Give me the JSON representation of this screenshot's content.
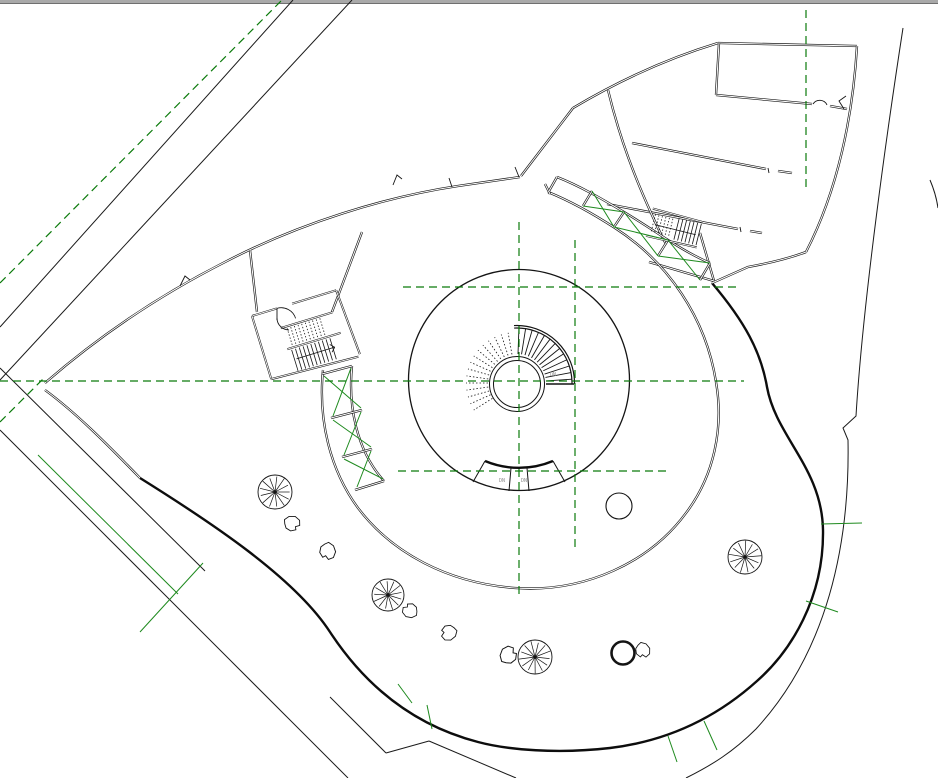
{
  "canvas": {
    "width": 938,
    "height": 778,
    "background": "#ffffff"
  },
  "colors": {
    "wall": "#141414",
    "site": "#1a1a1a",
    "bold": "#0d0d0d",
    "ref_green": "#0a7a0a",
    "accent_green": "#1e8a1e",
    "topbar_fill": "#a9a9a9",
    "topbar_edge": "#6f6f6f",
    "label_gray": "#8f8f8f",
    "white": "#ffffff"
  },
  "labels": {
    "down_labels": [
      {
        "text": "DN",
        "x": 550,
        "y": 376
      },
      {
        "text": "DN",
        "x": 499,
        "y": 482
      },
      {
        "text": "DN",
        "x": 521,
        "y": 482
      }
    ]
  },
  "window_edge": {
    "bar": {
      "x": 0,
      "y": 0,
      "w": 938,
      "h": 3
    },
    "edge_y": 3.5
  },
  "reference_grid": {
    "dash": "8 5",
    "lines": [
      {
        "x1": 403,
        "y1": 287,
        "x2": 737,
        "y2": 287
      },
      {
        "x1": 0,
        "y1": 381,
        "x2": 744,
        "y2": 381
      },
      {
        "x1": 398,
        "y1": 471,
        "x2": 666,
        "y2": 471
      },
      {
        "x1": 519,
        "y1": 222,
        "x2": 519,
        "y2": 597
      },
      {
        "x1": 575,
        "y1": 240,
        "x2": 575,
        "y2": 547
      },
      {
        "x1": 806,
        "y1": 10,
        "x2": 806,
        "y2": 190
      },
      {
        "x1": 0,
        "y1": 283,
        "x2": 282,
        "y2": 0
      },
      {
        "x1": 0,
        "y1": 422,
        "x2": 44,
        "y2": 378
      }
    ]
  },
  "site_lines": {
    "thin": [
      [
        0,
        327,
        293,
        0
      ],
      [
        0,
        380,
        352,
        0
      ],
      [
        0,
        368,
        205,
        571
      ],
      [
        0,
        430,
        348,
        778
      ],
      [
        330,
        697,
        386,
        753
      ],
      [
        386,
        753,
        429,
        741
      ],
      [
        429,
        741,
        516,
        778
      ]
    ],
    "green_solid": [
      [
        38,
        455,
        178,
        594
      ],
      [
        203,
        563,
        140,
        632
      ]
    ],
    "outer_arcs": [
      "M903,28 C888,125 863,300 856,416 L843,428 L848,440 C850,545 827,652 756,729 C733,752 712,765 686,778",
      "M930,180 Q936,194 938,208"
    ],
    "green_ticks": [
      [
        821,
        524,
        862,
        523
      ],
      [
        806,
        601,
        838,
        612
      ],
      [
        668,
        736,
        677,
        762
      ],
      [
        704,
        721,
        717,
        750
      ],
      [
        398,
        684,
        412,
        703
      ],
      [
        427,
        705,
        432,
        729
      ]
    ]
  },
  "plaza": {
    "bold_edge": "M712,283 C745,322 761,352 767,387 C776,437 822,468 823,530 C824,598 791,651 757,681 C717,717 668,741 610,748 C558,754 508,750 478,742 C424,728 372,696 330,632 C295,578 212,523 140,478"
  },
  "building": {
    "double_walls": [
      "M45,383 C100,335 160,295 225,262 C300,223 385,197 458,186 L520,177",
      "M45,390 C75,412 105,442 140,478",
      "M521,176 L573,108",
      "M573,108 C615,83 662,60 718,43",
      "M718,43 L857,46",
      "M857,46 C853,115 838,190 806,252",
      "M719,43 L716,95",
      "M716,95 L812,104 M830,106 L847,109",
      "M632,143 L766,169 M778,171 L792,173",
      "M607,204 L738,229 M750,231 L762,233",
      "M806,252 C790,258 770,263 748,267 L712,283",
      "M608,90 C620,140 636,180 652,215 C657,226 661,235 666,244",
      "M700,233 L714,281",
      "M649,262 L714,281",
      "M323,370 C318,420 330,470 358,508 C392,553 448,583 515,588 C585,593 650,562 686,513 C714,476 724,428 716,382 C706,318 668,262 615,228 C592,213 570,201 548,192",
      "M332,312 C341,288 352,259 362,232",
      "M257,312 L250,250",
      "M545,184 L550,194"
    ],
    "band_left": {
      "outer_edge": "M352,366 C348,405 356,450 384,481",
      "rungs": [
        [
          322,
          374,
          352,
          366
        ],
        [
          331,
          418,
          362,
          410
        ],
        [
          342,
          457,
          372,
          449
        ],
        [
          355,
          490,
          384,
          481
        ]
      ],
      "braces": [
        [
          324,
          376,
          361,
          408
        ],
        [
          351,
          368,
          333,
          416
        ],
        [
          333,
          420,
          371,
          447
        ],
        [
          361,
          412,
          344,
          455
        ],
        [
          344,
          459,
          383,
          479
        ],
        [
          371,
          451,
          357,
          487
        ]
      ]
    },
    "band_right": {
      "outer_edge": "M557,177 C580,186 602,199 624,212 C639,221 654,231 668,240 C682,249 696,257 710,263",
      "rungs": [
        [
          549,
          191,
          557,
          177
        ],
        [
          583,
          206,
          592,
          191
        ],
        [
          614,
          227,
          624,
          212
        ],
        [
          658,
          256,
          668,
          240
        ],
        [
          700,
          280,
          710,
          263
        ]
      ],
      "braces": [
        [
          583,
          206,
          624,
          212
        ],
        [
          592,
          191,
          614,
          227
        ],
        [
          614,
          227,
          668,
          240
        ],
        [
          624,
          212,
          658,
          256
        ],
        [
          658,
          256,
          710,
          263
        ],
        [
          668,
          240,
          700,
          280
        ]
      ]
    },
    "notches": [
      "M180,286 L185,276 L190,280",
      "M393,185 L397,175 L402,179",
      "M519,177 L515,167",
      "M452,187 L449,178",
      "M846,96 L839,101 L844,109",
      "M813,104 A8,8 0 0 1 827,105",
      "M768,168 L769,173",
      "M740,227 L741,232",
      "M277,318 A12,12 0 0 0 289,330",
      "M277,308 L277,320"
    ]
  },
  "drum": {
    "outer_circle": {
      "cx": 519,
      "cy": 380,
      "r": 110.5
    },
    "core_circles": [
      {
        "cx": 517,
        "cy": 384,
        "r": 27.5
      },
      {
        "cx": 517,
        "cy": 384,
        "r": 23.5
      }
    ],
    "spiral_stair": {
      "cx": 517,
      "cy": 383,
      "r_inner": 29,
      "r_tread": 55,
      "r_arc1": 55,
      "r_arc2": 57.5,
      "solid_start_deg": -88,
      "solid_end_deg": -4,
      "solid_step_deg": 7,
      "arc_start_deg": -93,
      "arc_end_deg": 1,
      "dotted_start_deg": -100,
      "dotted_end_deg": -212,
      "dotted_step_deg": -8,
      "r_dotted_outer": 51,
      "end_cap": "M546,384 L574,384"
    },
    "bottom_arc": {
      "bold": "M485,461 A88,88 0 0 0 553,461",
      "flares": [
        [
          485,
          461,
          473,
          482
        ],
        [
          553,
          461,
          565,
          482
        ]
      ],
      "ticks": [
        [
          511,
          468,
          509,
          491
        ],
        [
          527,
          468,
          529,
          491
        ]
      ]
    }
  },
  "stairs": [
    {
      "name": "stair-left-wing",
      "transform": "translate(252,316) rotate(-17)",
      "walls": [
        "M0,0 L26,0 M42,0 L88,0",
        "M0,0 L0,66",
        "M0,66 L90,70",
        "M88,0 L92,68",
        "M24,20 L78,20",
        "M24,42 L80,42"
      ],
      "door_arc": "M26,0 A15,15 0 0 1 41,15",
      "rows": [
        {
          "x0": 30,
          "dx": 3.8,
          "n": 10,
          "y0": 22,
          "y1": 40,
          "dotted": true
        },
        {
          "x0": 28,
          "dx": 4.0,
          "n": 11,
          "y0": 44,
          "y1": 66,
          "dotted": false
        }
      ],
      "arrow": [
        [
          30,
          54,
          70,
          54
        ],
        [
          66,
          50,
          70,
          54
        ],
        [
          66,
          58,
          70,
          54
        ]
      ]
    },
    {
      "name": "stair-right-wing",
      "transform": "translate(654,212) rotate(14)",
      "walls": [
        "M-2,-3 L50,-2",
        "M-2,25 L50,24"
      ],
      "door_arc": "",
      "rows": [
        {
          "x0": 2,
          "dx": 3.6,
          "n": 6,
          "y0": 2,
          "y1": 20,
          "dotted": true
        },
        {
          "x0": 26,
          "dx": 3.8,
          "n": 7,
          "y0": 0,
          "y1": 22,
          "dotted": false
        }
      ],
      "arrow": [
        [
          4,
          12,
          46,
          12
        ]
      ]
    }
  ],
  "landscape": {
    "trees": [
      {
        "cx": 275,
        "cy": 492,
        "r": 17
      },
      {
        "cx": 388,
        "cy": 595,
        "r": 16
      },
      {
        "cx": 535,
        "cy": 657,
        "r": 17
      },
      {
        "cx": 745,
        "cy": 557,
        "r": 17
      }
    ],
    "tree_spokes": 13,
    "plain_circles": [
      {
        "cx": 619,
        "cy": 506,
        "r": 13,
        "w": 1.1
      },
      {
        "cx": 623,
        "cy": 653,
        "r": 11.5,
        "w": 2.6
      }
    ],
    "rock_shape": [
      [
        -8,
        -2
      ],
      [
        -4,
        -6
      ],
      [
        2,
        -7
      ],
      [
        7,
        -4
      ],
      [
        8,
        1
      ],
      [
        4,
        3
      ],
      [
        5,
        6
      ],
      [
        0,
        8
      ],
      [
        -5,
        6
      ],
      [
        -7,
        2
      ]
    ],
    "rocks": [
      {
        "x": 292,
        "y": 523,
        "rot": 10,
        "s": 1.0
      },
      {
        "x": 328,
        "y": 551,
        "rot": 80,
        "s": 1.05
      },
      {
        "x": 410,
        "y": 611,
        "rot": 200,
        "s": 0.95
      },
      {
        "x": 449,
        "y": 633,
        "rot": 150,
        "s": 1.0
      },
      {
        "x": 508,
        "y": 655,
        "rot": 300,
        "s": 1.1
      },
      {
        "x": 643,
        "y": 650,
        "rot": 60,
        "s": 0.95
      }
    ]
  }
}
